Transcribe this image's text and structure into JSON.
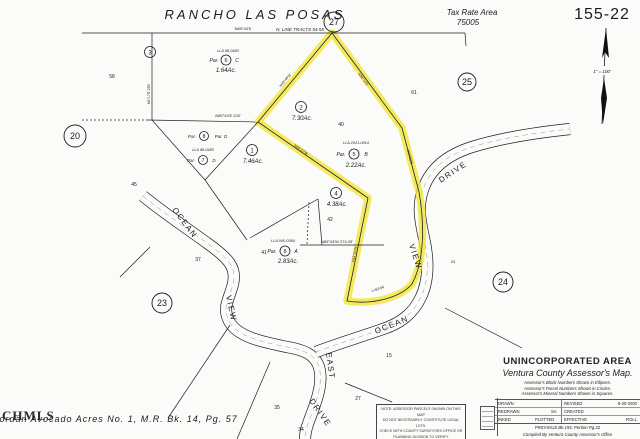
{
  "colors": {
    "highlight": "#f2e636",
    "ink": "#1c1c1c",
    "paper": "#fbfbf9"
  },
  "header": {
    "title": "RANCHO LAS POSAS",
    "tax_rate_area_label": "Tax Rate Area",
    "tax_rate_area_value": "75005",
    "sheet_number": "155-22"
  },
  "north_arrow": {
    "scale_text": "1\" = 100'"
  },
  "boundary_labels": {
    "top_bearing": "N89°43'E",
    "top_line_name": "N. LINE TRACTS 54-55",
    "mid_bearing": "N89°43'E  220'",
    "par8a_bearing": "N89°43'W  274.29'",
    "diag_bearing": "N55°17'W",
    "vert_bearing": "N11°32'W",
    "right_bearing": "N14°52'E",
    "apex_left_bearing": "N39°46'W",
    "apex_right_bearing": "N36°14'E",
    "west_bearing": "N0°17'E 250'",
    "curve_length": "L=63.84'"
  },
  "blocks": {
    "b20": "20",
    "b23": "23",
    "b24": "24",
    "b25": "25",
    "b27": "27"
  },
  "parcels": {
    "p1": {
      "num": "1",
      "acreage": "7.46Ac."
    },
    "p2": {
      "num": "2",
      "acreage": "7.30Ac."
    },
    "p3": {
      "num": "3"
    },
    "p4": {
      "num": "4",
      "acreage": "4.38Ac."
    },
    "p5": {
      "lla": "LLA 2021-0014",
      "prefix": "Par.",
      "num": "5",
      "suffix": "B",
      "acreage": "2.22Ac."
    },
    "p6": {
      "lla": "LLA 98-0483",
      "prefix": "Par.",
      "num": "6",
      "suffix": "C",
      "acreage": "1.64Ac."
    },
    "p7": {
      "lla": "LLA 98-0483",
      "prefix": "Par.",
      "num": "7",
      "suffix": "D"
    },
    "p8d": {
      "prefix": "Par.",
      "num": "8",
      "suffix": "Par. D"
    },
    "p8a": {
      "lla": "LLA 060-0384",
      "prefix": "Par.",
      "num": "8",
      "suffix": "A",
      "acreage": "2.83Ac."
    }
  },
  "lots": {
    "l58": "58",
    "l45": "45",
    "l37": "37",
    "l40": "40",
    "l42": "42",
    "l41": "41",
    "l61": "61",
    "l24": "24",
    "l15": "15",
    "l27": "27",
    "l35": "35",
    "l34": "34"
  },
  "roads": {
    "ocean_w": "OCEAN",
    "view_w": "VIEW",
    "east": "EAST",
    "drive_s": "DRIVE",
    "ocean_e": "OCEAN",
    "view_e": "VIEW",
    "drive_e": "DRIVE"
  },
  "note_box": {
    "line1": "NOTE: ASSESSOR PARCELS SHOWN ON THIS MAP",
    "line2": "DO NOT NECESSARILY CONSTITUTE LEGAL LOTS.",
    "line3": "CHECK WITH COUNTY SURVEYORS OFFICE OR",
    "line4": "PLANNING DIVISION TO VERIFY."
  },
  "footer": {
    "watermark": "CHMLS",
    "subdivision": "Jordan Avocado Acres No. 1, M.R. Bk. 14, Pg. 57"
  },
  "title_block": {
    "area": "UNINCORPORATED AREA",
    "map_name": "Ventura County Assessor's Map.",
    "note1": "Assessor's Block Numbers Shown in Ellipses.",
    "note2": "Assessor's Parcel Numbers Shown in Circles.",
    "note3": "Assessor's Mineral Numbers Shown in Squares.",
    "drawn": "DRAWN",
    "revised": "REVISED",
    "revised_date": "9-20-2000",
    "redrawn": "REDRAWN",
    "redrawn_by": "SA",
    "created": "CREATED",
    "inked": "INKED",
    "plotted": "PLOTTED",
    "effective": "EFFECTIVE",
    "roll": "ROLL",
    "previous": "PREVIOUS Bk.155, Portion Pg.22",
    "compiled": "Compiled By Ventura County Assessor's Office"
  }
}
